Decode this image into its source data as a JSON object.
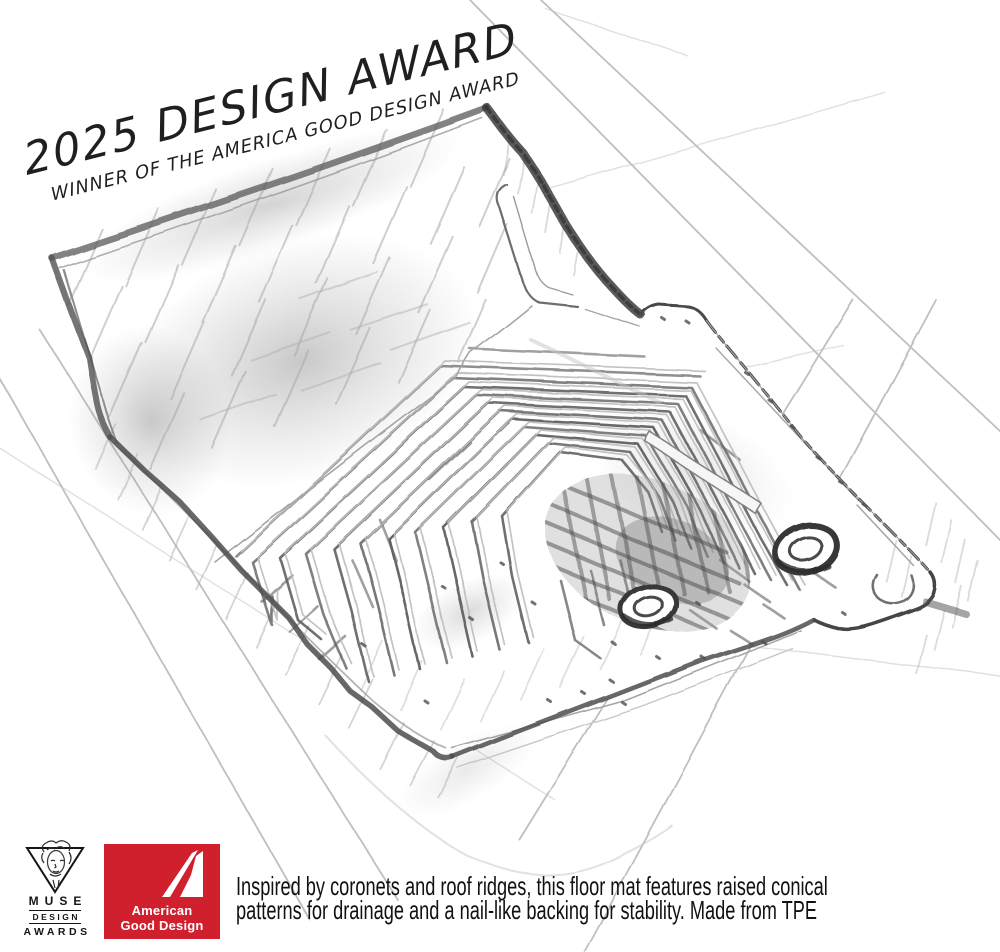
{
  "artwork": {
    "title": "2025 DESIGN AWARD",
    "subtitle": "WINNER OF THE AMERICA GOOD DESIGN AWARD",
    "subject": "pencil sketch of a vehicle floor mat with chevron drainage ridges and two grommet holes"
  },
  "description": {
    "lines": [
      "Inspired by coronets and roof ridges, this floor mat features raised conical",
      "patterns for drainage and a nail-like backing for stability. Made from TPE"
    ]
  },
  "logos": {
    "muse": {
      "name": "MUSE Design Awards",
      "line1": "MUSE",
      "line2": "DESIGN",
      "line3": "AWARDS"
    },
    "agd": {
      "name": "American Good Design",
      "line1": "American",
      "line2": "Good Design",
      "background": "#d0202e"
    }
  },
  "colors": {
    "brand_red": "#d0202e",
    "pencil_dark": "#3d3d3d",
    "pencil_mid": "#6e6e6e",
    "pencil_light": "#b5b5b5",
    "background": "#ffffff"
  }
}
